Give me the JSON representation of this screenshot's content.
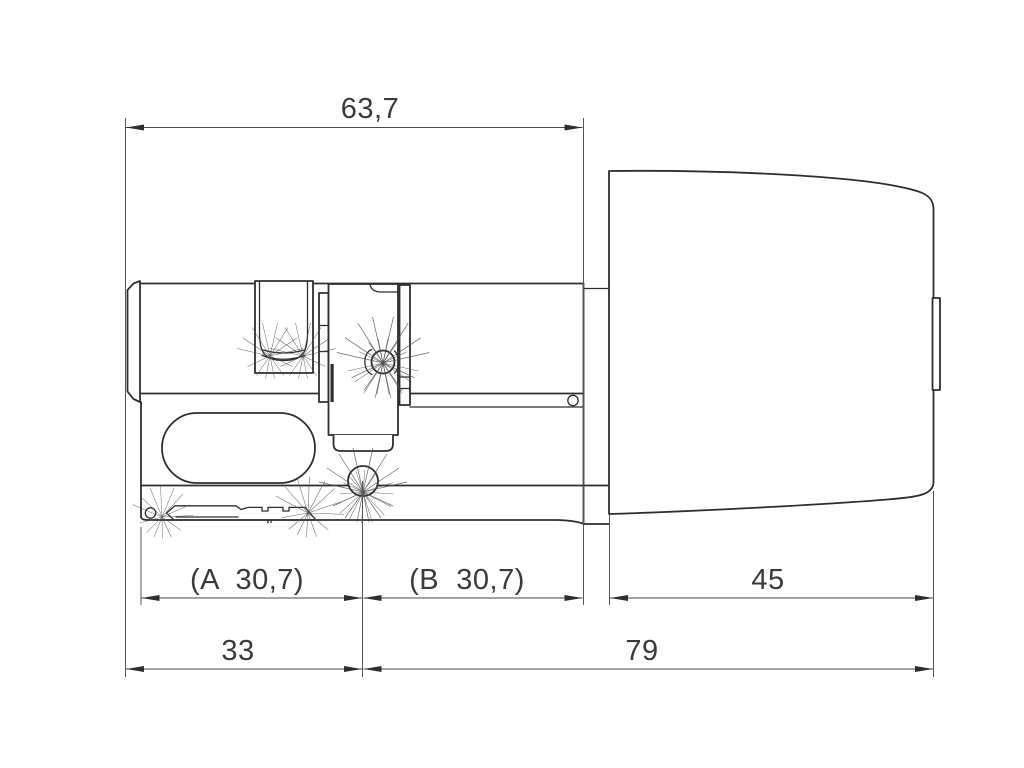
{
  "drawing": {
    "labels": {
      "overall_top": "63,7",
      "half_a": "(A  30,7)",
      "half_b": "(B  30,7)",
      "knob_length": "45",
      "body_length": "33",
      "knob_side_length": "79"
    },
    "colors": {
      "geometry_line": "#2e2e2e",
      "dimension_line": "#4a4a4a",
      "label_text": "#3a3a3a",
      "background": "#ffffff"
    }
  }
}
